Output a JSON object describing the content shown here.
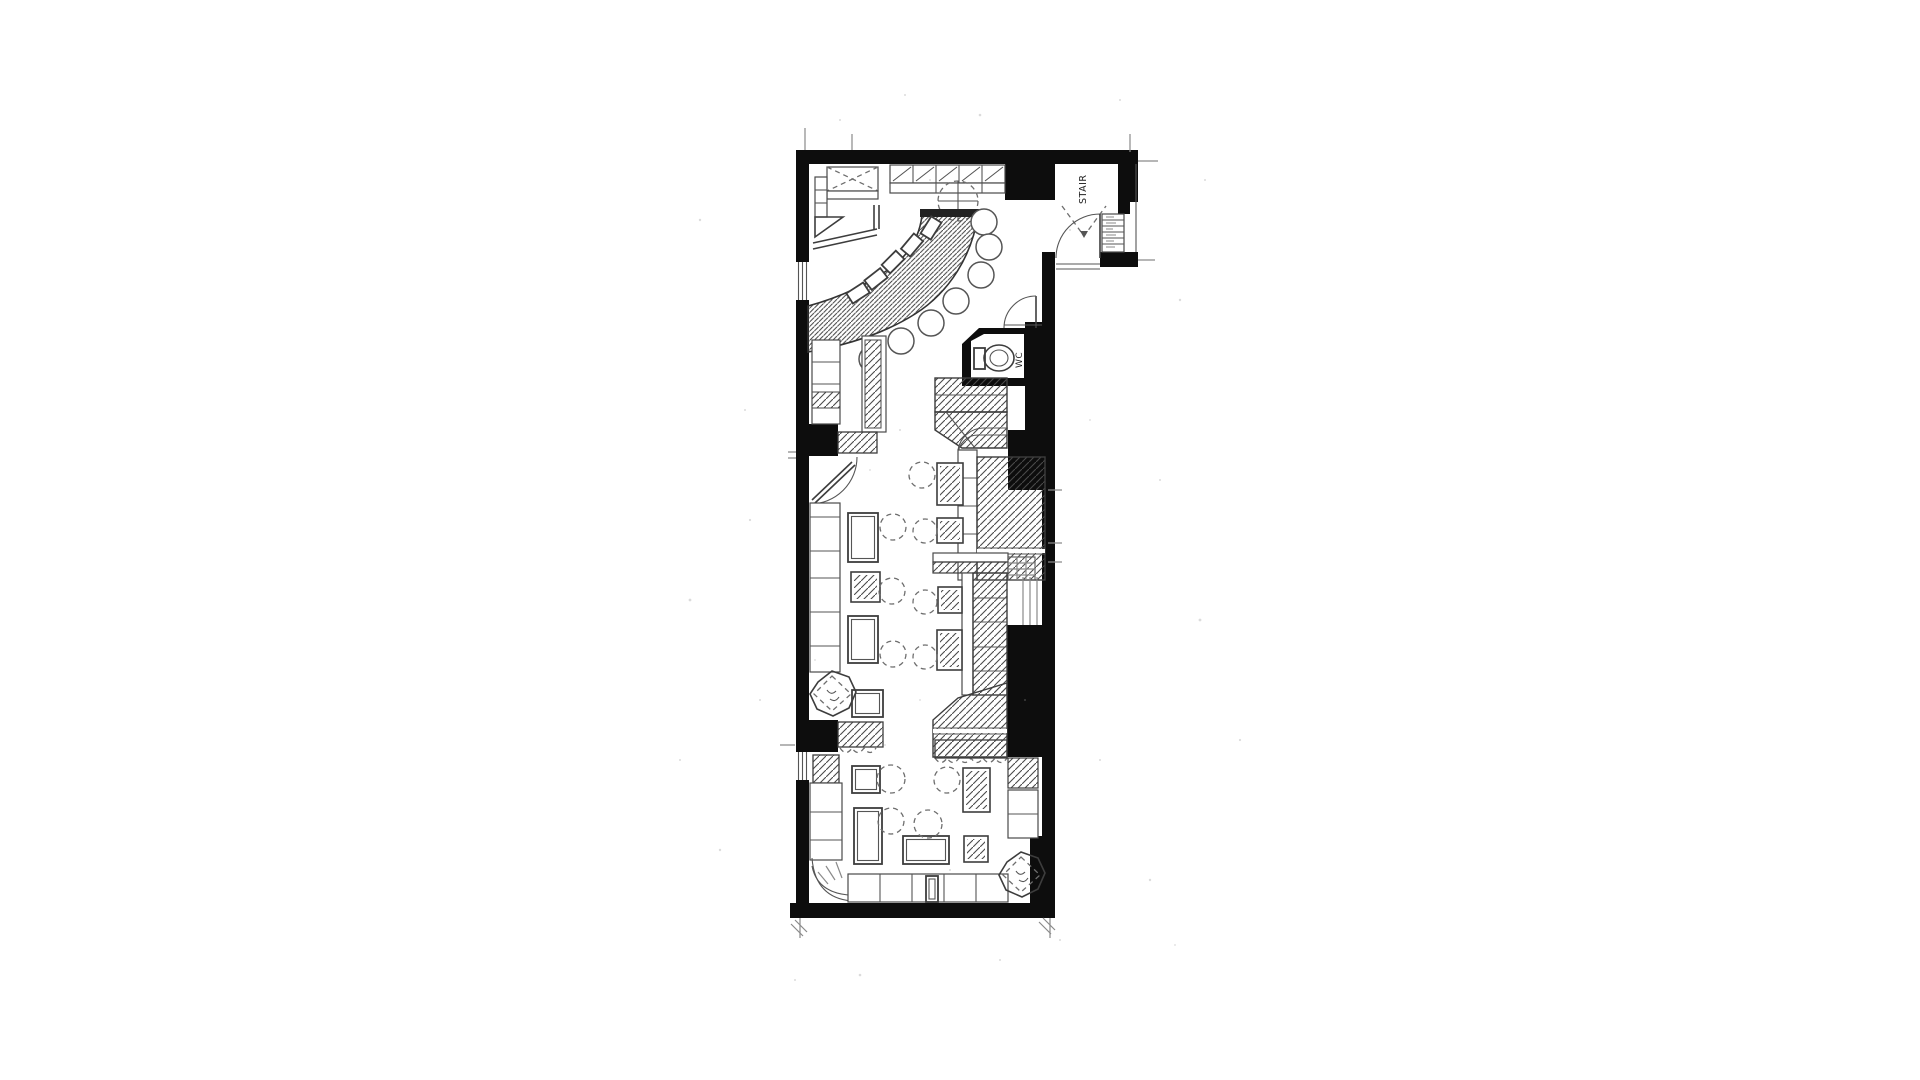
{
  "document": {
    "type": "scanned architectural floor plan",
    "style": "black-and-white line drawing with diagonal hatching, centered on white page",
    "orientation": "tall narrow unit; entrance vestibule and stair at top-right"
  },
  "labels": {
    "stair": "STAIR",
    "wc": "WC"
  },
  "colors": {
    "wall": "#0d0d0d",
    "line_dark": "#3d3d3d",
    "line": "#555555",
    "line_light": "#8a8a8a",
    "paper": "#ffffff"
  },
  "legend": {
    "rooms": [
      "bar area with curved counter",
      "stair vestibule",
      "wc",
      "dining area",
      "rear lounge"
    ],
    "furniture_counts": {
      "bar_stools": 7,
      "tables": 13,
      "chair_circles": 12,
      "octagonal_planters": 2,
      "toilet": 1
    }
  }
}
